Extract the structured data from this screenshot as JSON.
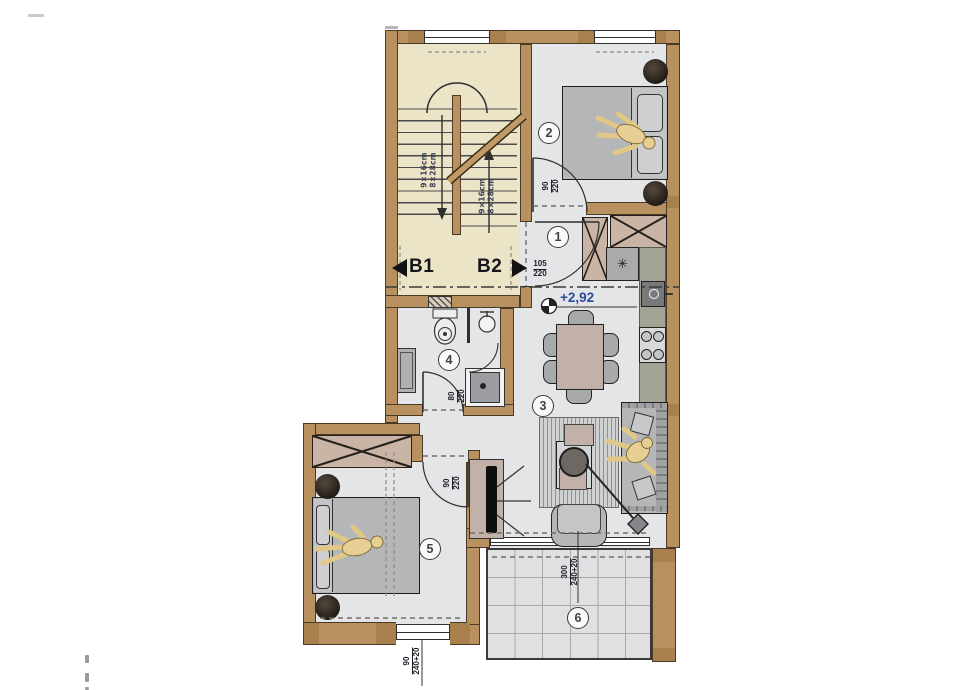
{
  "colors": {
    "wall": "#b9905f",
    "wall_outline": "#4a3a26",
    "stair_floor": "#ece4c6",
    "room_floor": "#e4e5e7",
    "balcony_floor": "#dfe0e2",
    "furniture_gray": "#b4b6b8",
    "wardrobe_fill": "#c9b4a6",
    "kitchen_counter": "#a2a295",
    "level_text": "#2b4b9b",
    "person_fill": "#e7cf93"
  },
  "stair": {
    "flight_label_line1": "9×16cm",
    "flight_label_line2": "8×28cm",
    "section_b1": "B1",
    "section_b2": "B2"
  },
  "level_marker": {
    "text": "+2,92"
  },
  "room_numbers": {
    "entry": "1",
    "bedroom_top": "2",
    "living": "3",
    "bathroom": "4",
    "bedroom_left": "5",
    "balcony": "6"
  },
  "door_labels": {
    "bedroom_top": {
      "w": "90",
      "h": "220"
    },
    "entrance": {
      "w": "105",
      "h": "220"
    },
    "bathroom": {
      "w": "80",
      "h": "220"
    },
    "bedroom_left": {
      "w": "90",
      "h": "220"
    }
  },
  "dim_labels": {
    "balcony_door": {
      "w": "300",
      "h": "240+20"
    },
    "bedroom_left_window": {
      "w": "90",
      "h": "240+20"
    }
  },
  "icons": {
    "fridge_asterisk": "✳"
  }
}
